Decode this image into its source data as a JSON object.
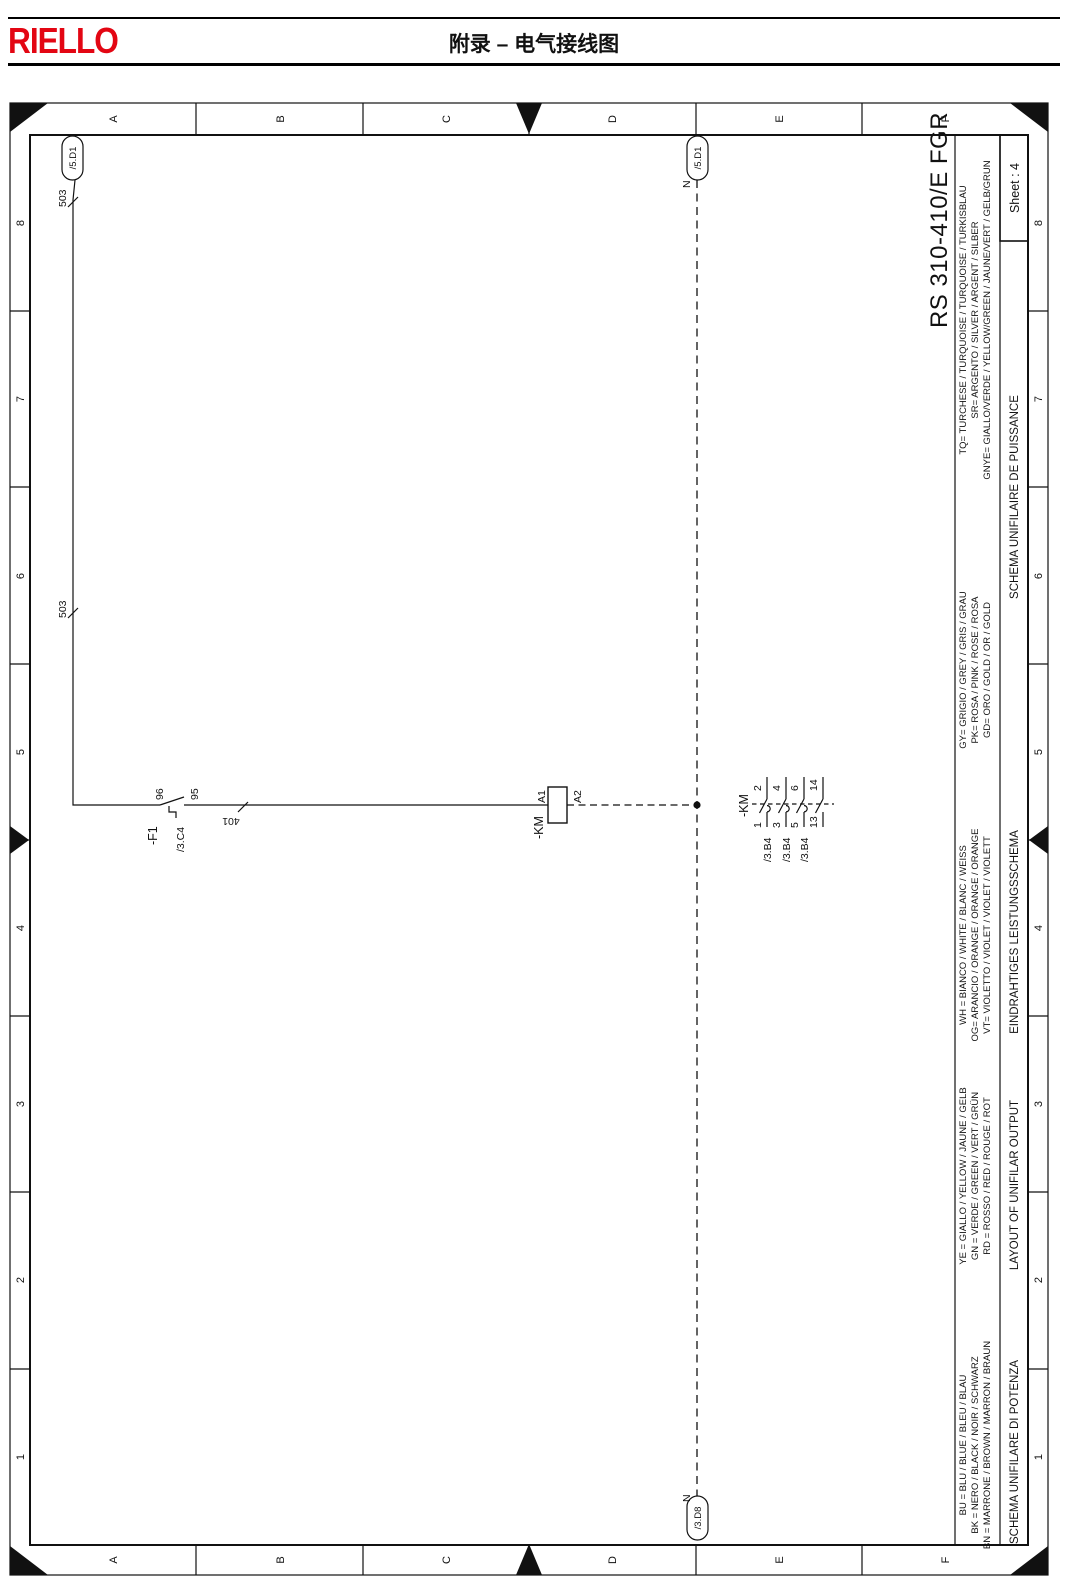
{
  "header": {
    "brand": "RIELLO",
    "title": "附录 – 电气接线图"
  },
  "colors": {
    "brand_red": "#e30613",
    "line": "#111111"
  },
  "frame": {
    "columns": [
      "A",
      "B",
      "C",
      "D",
      "E",
      "F"
    ],
    "rows": [
      "8",
      "7",
      "6",
      "5",
      "4",
      "3",
      "2",
      "1"
    ],
    "sheet_label": "Sheet : 4",
    "drawing_code": "RS 310-410/E FGR"
  },
  "titles": [
    "SCHEMA UNIFILAIRE DE PUISSANCE",
    "EINDRAHTIGES LEISTUNGSSCHEMA",
    "LAYOUT OF UNIFILAR OUTPUT",
    "SCHEMA UNIFILARE DI POTENZA"
  ],
  "color_legend": {
    "groups": [
      [
        "TQ= TURCHESE / TURQUOISE / TURQUOISE / TURKISBLAU",
        "SR= ARGENTO / SILVER / ARGENT / SILBER",
        "GNYE= GIALLO/VERDE / YELLOW/GREEN / JAUNE/VERT / GELB/GRUN"
      ],
      [
        "GY= GRIGIO / GREY / GRIS / GRAU",
        "PK= ROSA / PINK / ROSE / ROSA",
        "GD= ORO / GOLD / OR / GOLD"
      ],
      [
        "WH = BIANCO / WHITE / BLANC / WEISS",
        "OG= ARANCIO / ORANGE / ORANGE / ORANGE",
        "VT= VIOLETTO / VIOLET / VIOLET / VIOLETT"
      ],
      [
        "YE = GIALLO / YELLOW / JAUNE / GELB",
        "GN = VERDE / GREEN / VERT / GRÜN",
        "RD = ROSSO / RED / ROUGE / ROT"
      ],
      [
        "BU = BLU / BLUE / BLEU / BLAU",
        "BK = NERO / BLACK / NOIR / SCHWARZ",
        "BN = MARRONE / BROWN / MARRON / BRAUN"
      ]
    ]
  },
  "schematic": {
    "wire503": {
      "label": "503",
      "ref": "/5.D1"
    },
    "wire401": {
      "label": "401"
    },
    "neutral": {
      "label": "N",
      "top_ref": "/5.D1",
      "bottom_ref": "/3.D8"
    },
    "f1": {
      "tag": "-F1",
      "ref": "/3.C4",
      "t96": "96",
      "t95": "95"
    },
    "km_coil": {
      "tag": "-KM",
      "a1": "A1",
      "a2": "A2"
    },
    "km_contacts": {
      "tag": "-KM",
      "items": [
        {
          "lower": "1",
          "upper": "2",
          "ref": "/3.B4"
        },
        {
          "lower": "3",
          "upper": "4",
          "ref": "/3.B4"
        },
        {
          "lower": "5",
          "upper": "6",
          "ref": "/3.B4"
        },
        {
          "lower": "13",
          "upper": "14"
        }
      ]
    }
  }
}
